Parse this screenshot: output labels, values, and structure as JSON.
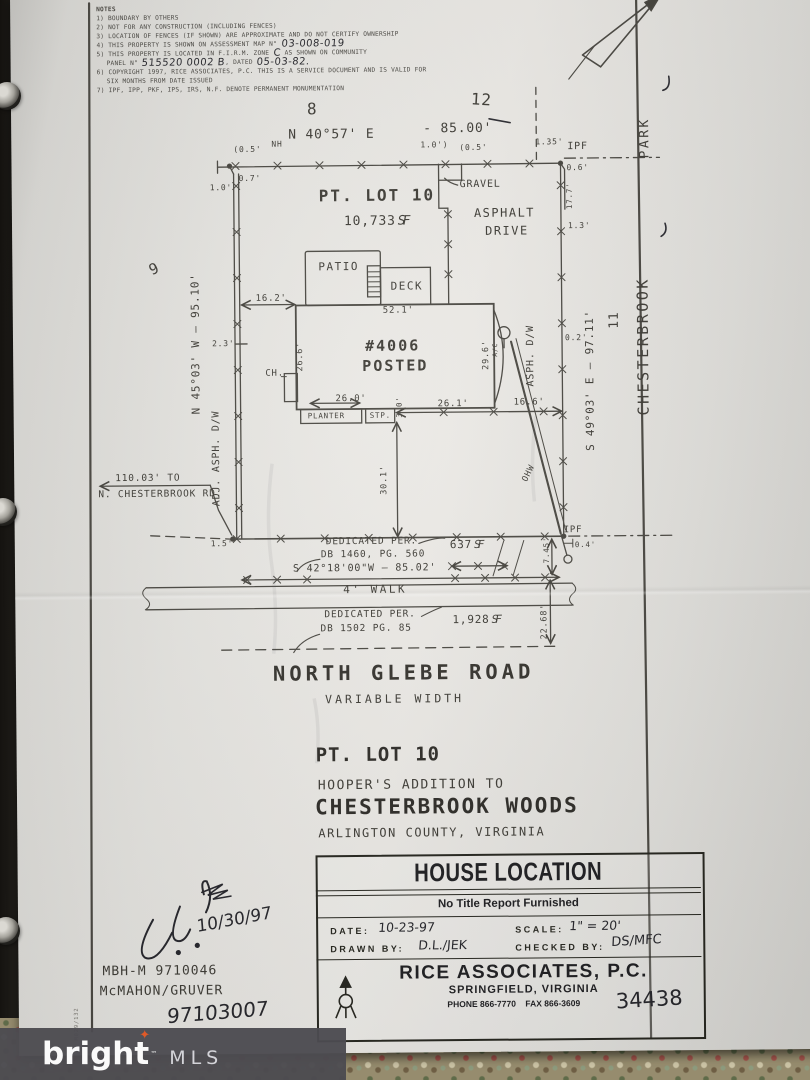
{
  "brand": {
    "name": "bright",
    "tm": "™",
    "suffix": "MLS"
  },
  "notes": {
    "title": "NOTES",
    "n1": "1) BOUNDARY BY OTHERS",
    "n2": "2) NOT FOR ANY CONSTRUCTION (INCLUDING FENCES)",
    "n3": "3) LOCATION OF FENCES (IF SHOWN) ARE APPROXIMATE AND DO NOT CERTIFY OWNERSHIP",
    "n4_pre": "4) THIS PROPERTY IS SHOWN ON ASSESSMENT MAP N°",
    "n4_hand": "03-008-019",
    "n5_pre": "5) THIS PROPERTY IS LOCATED IN F.I.R.M. ZONE",
    "n5_hand": "C",
    "n5_post": "AS SHOWN ON COMMUNITY",
    "n5b_pre": "PANEL N°",
    "n5b_hand": "515520 0002 B",
    "n5b_mid": ", DATED",
    "n5b_hand2": "05-03-82.",
    "n6": "6) COPYRIGHT 1997, RICE ASSOCIATES, P.C. THIS IS A SERVICE DOCUMENT AND IS VALID FOR",
    "n6b": "SIX MONTHS FROM DATE ISSUED",
    "n7": "7) IPF, IPP, PKF, IPS, IRS, N.F. DENOTE PERMANENT MONUMENTATION"
  },
  "plat": {
    "lot8": "8",
    "lot12": "12",
    "lot9": "9",
    "lot11": "11",
    "bearing_top": "N 40°57' E",
    "dist_top": "-  85.00'",
    "bearing_left": "N 45°03' W  –  95.10'",
    "bearing_right": "S 49°03' E  –  97.11'",
    "bearing_bottom": "S 42°18'00\"W – 85.02'",
    "adj_asph_dw": "ADJ. ASPH. D/W",
    "asph_dw": "ASPH. D/W",
    "street_side": "CHESTERBROOK",
    "street_side2": "PARK",
    "pt_lot": "PT. LOT 10",
    "area_value": "10,733",
    "sf": "SF",
    "gravel": "GRAVEL",
    "asphalt": "ASPHALT",
    "drive": "DRIVE",
    "patio": "PATIO",
    "deck": "DECK",
    "house_no": "#4006",
    "posted": "POSTED",
    "ch": "CH.",
    "planter": "PLANTER",
    "stp": "STP.",
    "ohw": "OHW",
    "ac": "A/C",
    "ipf": "IPF",
    "nh": "NH",
    "to_road1": "110.03' TO",
    "to_road2": "N. CHESTERBROOK RD.",
    "ded_per": "DEDICATED PER.",
    "ded1_ref": "DB 1460, PG. 560",
    "ded2_ref": "DB 1502 PG. 85",
    "area_637": "637",
    "area_1928": "1,928",
    "walk": "4' WALK",
    "d_05p": "(0.5'",
    "d_10p": "1.0')",
    "d_135": "1.35'",
    "d_06": "0.6'",
    "d_07": "0.7'",
    "d_10": "1.0'",
    "d_177": "17.7'",
    "d_13": "1.3'",
    "d_02": "0.2'",
    "d_23": "2.3'",
    "d_162": "16.2'",
    "d_521": "52.1'",
    "d_266": "26.6'",
    "d_296": "29.6'",
    "d_260": "26.0'",
    "d_30": "3.0'",
    "d_261": "26.1'",
    "d_166": "16.6'",
    "d_301": "30.1'",
    "d_15": "1.5'",
    "d_745": "7.45'",
    "d_04": "0.4'",
    "d_2268": "22.68'"
  },
  "road": {
    "name": "NORTH GLEBE ROAD",
    "width": "VARIABLE WIDTH"
  },
  "subdivision": {
    "line1": "PT. LOT 10",
    "line2": "HOOPER'S ADDITION TO",
    "line3": "CHESTERBROOK WOODS",
    "line4": "ARLINGTON COUNTY, VIRGINIA"
  },
  "titleblock": {
    "title": "HOUSE LOCATION",
    "subtitle": "No Title Report Furnished",
    "date_label": "DATE:",
    "date_value": "10-23-97",
    "scale_label": "SCALE:",
    "scale_value": "1\" = 20'",
    "drawn_label": "DRAWN BY:",
    "drawn_value": "D.L./JEK",
    "checked_label": "CHECKED BY:",
    "checked_value": "DS/MFC",
    "firm": "RICE ASSOCIATES, P.C.",
    "firm_city": "SPRINGFIELD, VIRGINIA",
    "firm_phone": "PHONE 866-7770",
    "firm_fax": "FAX 866-3609",
    "job_no": "34438"
  },
  "annotations": {
    "sig_date": "10/30/97",
    "file1": "MBH-M 9710046",
    "file2": "McMAHON/GRUVER",
    "file3": "97103007",
    "edge_code": "M029/132"
  }
}
